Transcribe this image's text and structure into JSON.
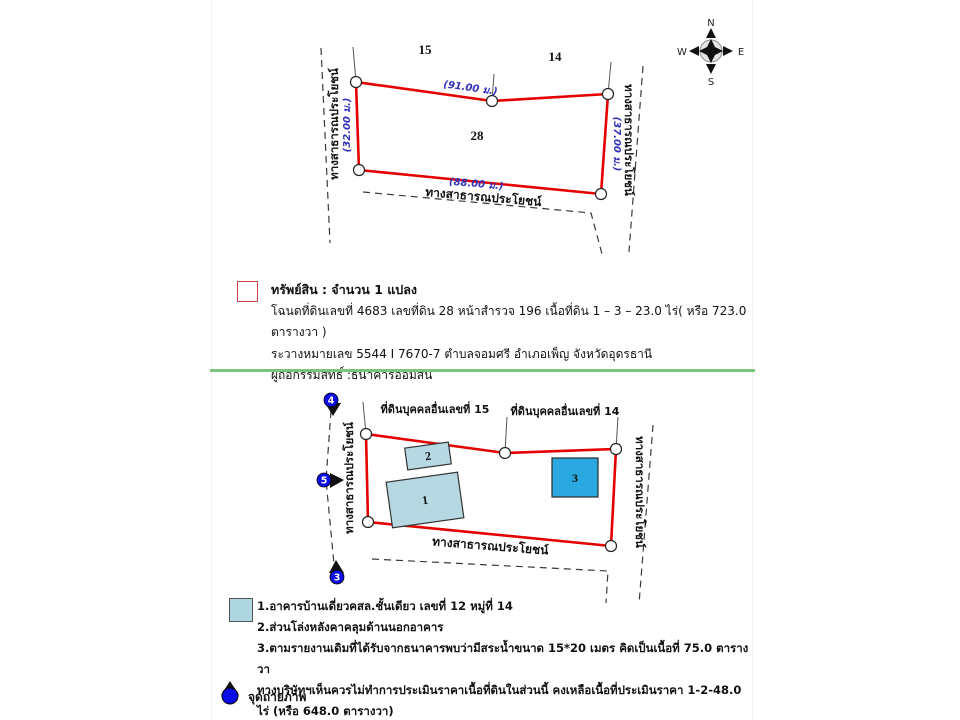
{
  "colors": {
    "plot_outline_red": "#e50000",
    "measurement_blue": "#3232bb",
    "building_light_blue": "#b5d8e2",
    "building_bright_blue": "#2aa8e0",
    "photo_marker_blue": "#0b0be6",
    "divider_green": "#7cc47c",
    "legend_red_border": "#cc4444"
  },
  "compass": {
    "n": "N",
    "e": "E",
    "s": "S",
    "w": "W"
  },
  "diagram1": {
    "adjacent_plot_left": "15",
    "adjacent_plot_right": "14",
    "plot_number": "28",
    "len_top": "(91.00 ม.)",
    "len_bottom": "(88.00 ม.)",
    "len_left": "(32.00 ม.)",
    "len_right": "(37.00 ม.)",
    "road_left": "ทางสาธารณประโยชน์",
    "road_right": "ทางสาธารณประโยชน์",
    "road_bottom": "ทางสาธารณประโยชน์"
  },
  "property": {
    "title": "ทรัพย์สิน : จำนวน 1 แปลง",
    "line1": "โฉนดที่ดินเลขที่ 4683 เลขที่ดิน 28 หน้าสำรวจ 196  เนื้อที่ดิน 1 – 3 – 23.0 ไร่( หรือ 723.0 ตารางวา )",
    "line2": "ระวางหมายเลข 5544 I 7670-7  ตำบลจอมศรี อำเภอเพ็ญ จังหวัดอุดรธานี",
    "line3": "ผู้ถือกรรมสิทธิ์ :ธนาคารออมสิน"
  },
  "diagram2": {
    "neighbor_left": "ที่ดินบุคคลอื่นเลขที่ 15",
    "neighbor_right": "ที่ดินบุคคลอื่นเลขที่ 14",
    "building1": "1",
    "building2": "2",
    "building3": "3",
    "photo_points": [
      "4",
      "5",
      "3"
    ],
    "road_left": "ทางสาธารณประโยชน์",
    "road_right": "ทางสาธารณประโยชน์",
    "road_bottom": "ทางสาธารณประโยชน์"
  },
  "legend": {
    "note1": "1.อาคารบ้านเดี่ยวคสล.ชั้นเดียว เลขที่ 12 หมู่ที่ 14",
    "note2": "2.ส่วนโล่งหลังคาคลุมด้านนอกอาคาร",
    "note3": "3.ตามรายงานเดิมที่ได้รับจากธนาคารพบว่ามีสระน้ำขนาด 15*20 เมตร คิดเป็นเนื้อที่ 75.0 ตารางวา",
    "note4": "ทางบริษัทฯเห็นควรไม่ทำการประเมินราคาเนื้อที่ดินในส่วนนี้ คงเหลือเนื้อที่ประเมินราคา 1-2-48.0 ไร่ (หรือ 648.0 ตารางวา)",
    "photo_point_label": "จุดถ่ายภาพ"
  }
}
